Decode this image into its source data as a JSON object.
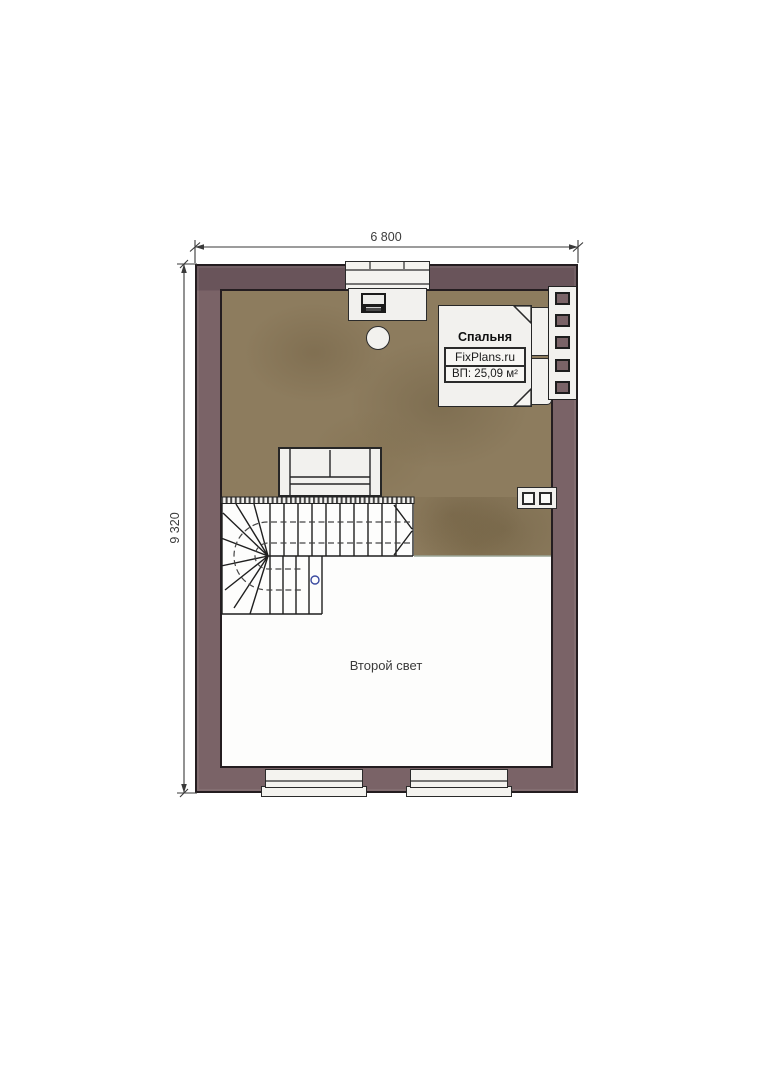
{
  "plan": {
    "dim_width": "6 800",
    "dim_height": "9 320",
    "bedroom_name": "Спальня",
    "brand": "FixPlans.ru",
    "area_info": "ВП: 25,09 м²",
    "void_name": "Второй свет"
  },
  "colors": {
    "wall": "#7a6367",
    "wall-dark": "#69545a",
    "outline": "#241d20",
    "floor": "#8d7c5e",
    "furniture": "#f2f1ee",
    "line": "#262626",
    "marker": "#3a4a9f"
  }
}
